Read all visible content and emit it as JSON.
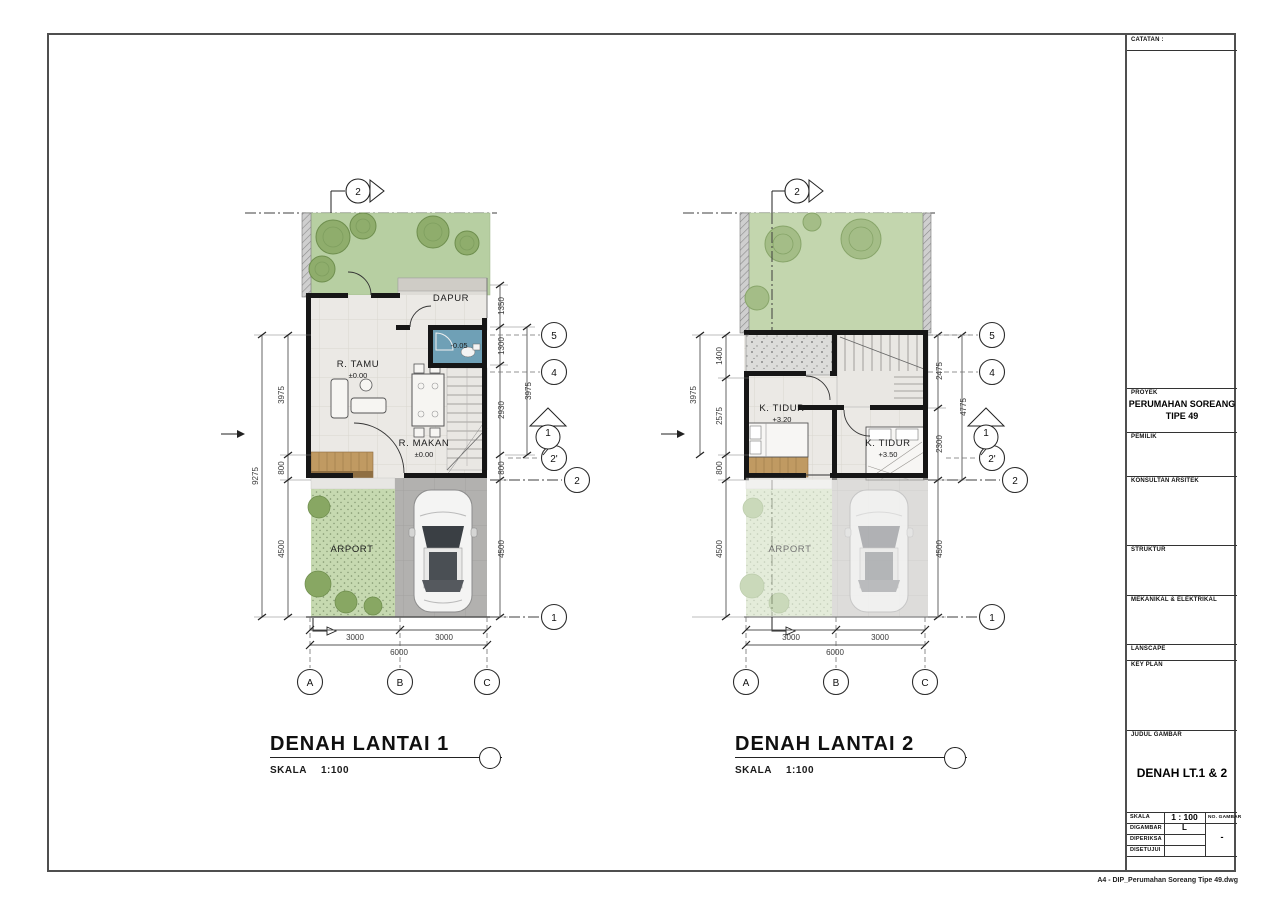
{
  "sheet": {
    "footer_note": "A4 - DIP_Perumahan Soreang Tipe 49.dwg"
  },
  "titleblock": {
    "catatan": "CATATAN :",
    "proyek_label": "PROYEK",
    "proyek_line1": "PERUMAHAN SOREANG",
    "proyek_line2": "TIPE 49",
    "pemilik_label": "PEMILIK",
    "konsultan_label": "KONSULTAN ARSITEK",
    "struktur_label": "STRUKTUR",
    "mekanikal_label": "MEKANIKAL & ELEKTRIKAL",
    "lanscape_label": "LANSCAPE",
    "keyplan_label": "KEY PLAN",
    "judul_label": "JUDUL GAMBAR",
    "judul_value": "DENAH LT.1 & 2",
    "skala_label": "SKALA",
    "skala_value": "1 : 100",
    "no_gambar_label": "NO. GAMBAR",
    "no_gambar_value": "-",
    "digambar_label": "DIGAMBAR",
    "digambar_value": "L",
    "diperiksa_label": "DIPERIKSA",
    "disetujui_label": "DISETUJUI"
  },
  "plan1": {
    "title": "DENAH LANTAI 1",
    "scale_label": "SKALA",
    "scale_value": "1:100",
    "rooms": {
      "dapur": "DAPUR",
      "bath_level": "-0.05",
      "tamu": "R. TAMU",
      "tamu_level": "±0.00",
      "makan": "R. MAKAN",
      "makan_level": "±0.00",
      "carport": "ARPORT"
    },
    "dims": {
      "left_total": "9275",
      "left": [
        "3975",
        "800",
        "4500"
      ],
      "right": [
        "1350",
        "1300",
        "2930",
        "800",
        "4500"
      ],
      "right_span": "3975",
      "bottom": [
        "3000",
        "3000"
      ],
      "bottom_total": "6000"
    },
    "grid": {
      "g5": "5",
      "g4": "4",
      "g2a": "2'",
      "g2": "2",
      "g1": "1",
      "gA": "A",
      "gB": "B",
      "gC": "C"
    },
    "markers": {
      "top_section": "2",
      "side_section": "1"
    }
  },
  "plan2": {
    "title": "DENAH LANTAI 2",
    "scale_label": "SKALA",
    "scale_value": "1:100",
    "rooms": {
      "tidur1": "K. TIDUR",
      "tidur1_level": "+3.20",
      "tidur2": "K. TIDUR",
      "tidur2_level": "+3.50",
      "carport": "ARPORT"
    },
    "dims": {
      "left_span": "3975",
      "left": [
        "1400",
        "2575",
        "800",
        "4500"
      ],
      "right": [
        "2475",
        "2300",
        "4500"
      ],
      "right_span": "4775",
      "bottom": [
        "3000",
        "3000"
      ],
      "bottom_total": "6000"
    },
    "grid": {
      "g5": "5",
      "g4": "4",
      "g2a": "2'",
      "g2": "2",
      "g1": "1",
      "gA": "A",
      "gB": "B",
      "gC": "C"
    },
    "markers": {
      "top_section": "2",
      "side_section": "1"
    }
  }
}
